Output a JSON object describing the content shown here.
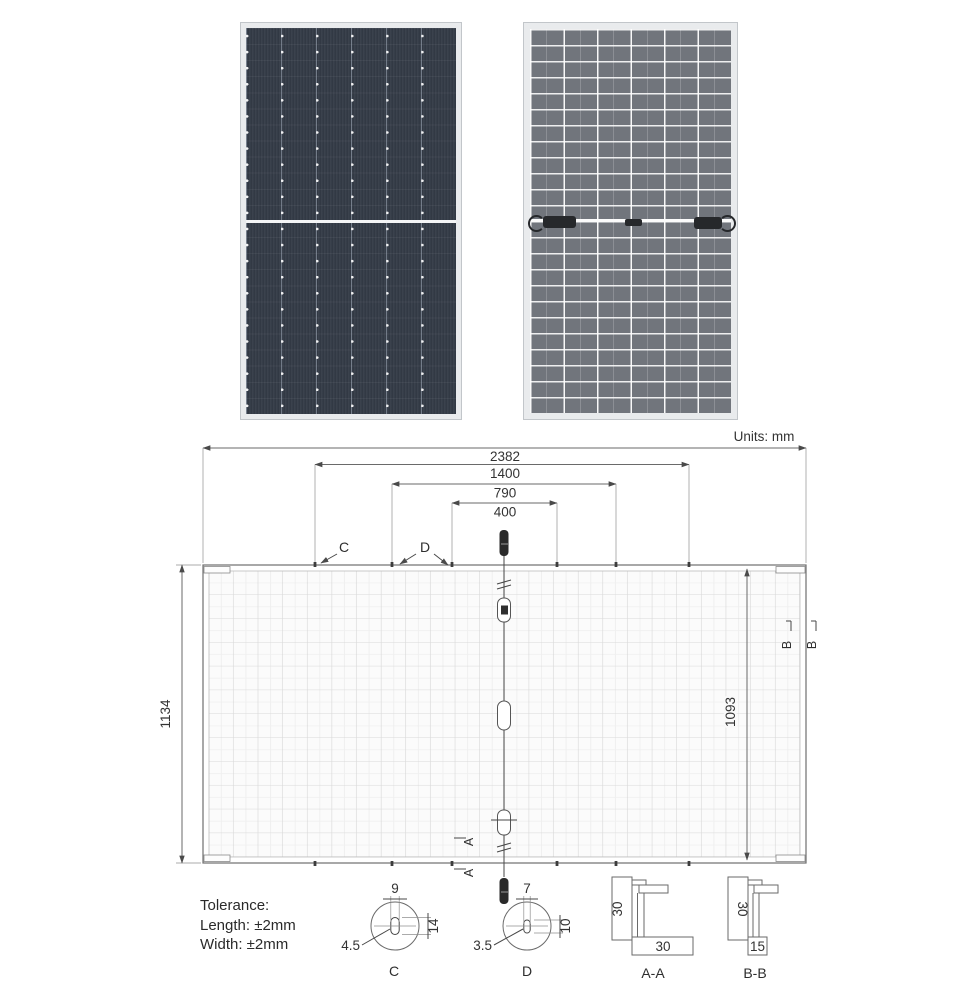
{
  "meta": {
    "units_label": "Units: mm"
  },
  "dims": {
    "overall_width": "2382",
    "mount_c_spacing": "1400",
    "mount_d_outer_spacing": "790",
    "mount_d_inner_spacing": "400",
    "overall_height": "1134",
    "inner_height": "1093"
  },
  "sections": {
    "a": "A",
    "b": "B"
  },
  "callouts": {
    "c": "C",
    "d": "D"
  },
  "tolerance": {
    "title": "Tolerance:",
    "length": "Length: ±2mm",
    "width": "Width: ±2mm"
  },
  "detail_c": {
    "top": "9",
    "side": "14",
    "leader": "4.5",
    "label": "C"
  },
  "detail_d": {
    "top": "7",
    "side": "10",
    "leader": "3.5",
    "label": "D"
  },
  "section_aa": {
    "height": "30",
    "width": "30",
    "label": "A-A"
  },
  "section_bb": {
    "height": "30",
    "width": "15",
    "label": "B-B"
  },
  "colors": {
    "front_face": "#343b47",
    "back_face": "#71757c",
    "frame": "#e9ebed",
    "junction_box": "#26282b",
    "line": "#6a6a6a",
    "text": "#333333"
  }
}
